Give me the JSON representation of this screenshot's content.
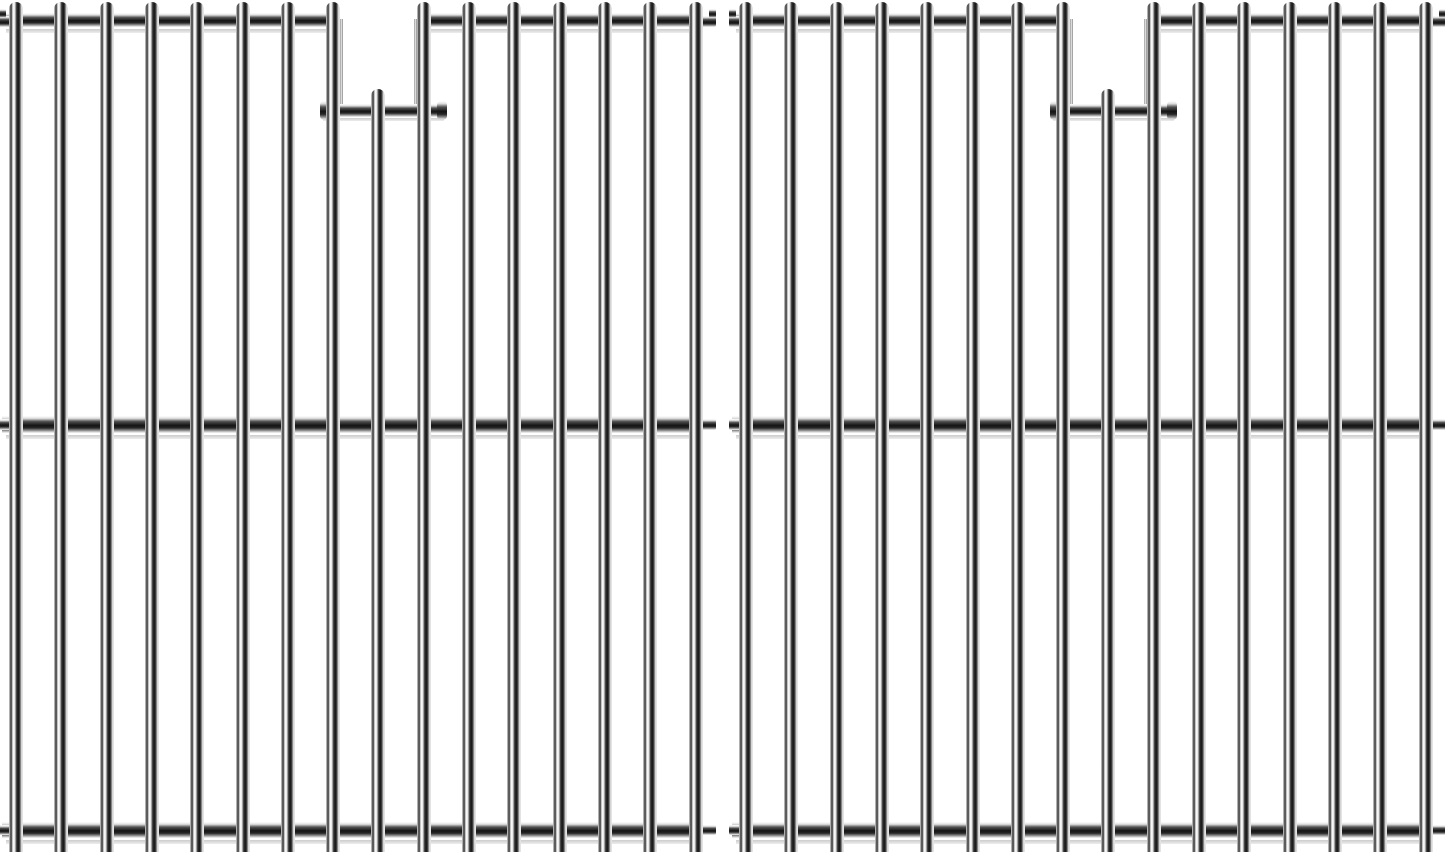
{
  "meta": {
    "description": "Product photo of a set of two identical stainless steel wire cooking grates (grill replacement grids) shown side by side on a plain white background. Each grate has sixteen polished vertical rods welded to top, middle and bottom cross supports, with a rectangular notch opening near the top formed by a lowered cross bar and one shortened rod.",
    "background_color": "#ffffff"
  },
  "panels": [
    {
      "id": "grate-panel-left",
      "x": 2
    },
    {
      "id": "grate-panel-right",
      "x": 732
    }
  ],
  "panel_spec": {
    "width": 715,
    "height": 852,
    "rods": {
      "count": 16,
      "width": 14,
      "first_center": 14,
      "spacing": 45.3,
      "top": 2,
      "cap_radius": 7,
      "short_index": 8,
      "short_top": 89
    },
    "top_bar": {
      "y": 13,
      "height": 14,
      "right_end": 701,
      "gap_start": 338,
      "gap_end": 415
    },
    "notch_bar": {
      "y": 104,
      "height": 13,
      "x": 321,
      "width": 121,
      "cap_width": 10,
      "cap_y": 101,
      "cap_height": 19
    },
    "middle_bar": {
      "y": 416,
      "height": 17,
      "right_end": 701
    },
    "bottom_bar": {
      "y": 822,
      "height": 16,
      "right_end": 701
    },
    "shadow_thickness": 4
  },
  "colors": {
    "background": "#ffffff",
    "steel_bright": "#ffffff",
    "steel_light": "#e2e2e2",
    "steel_mid": "#8e8e8e",
    "steel_dark": "#141414",
    "shadow": "#c3c3c3"
  }
}
